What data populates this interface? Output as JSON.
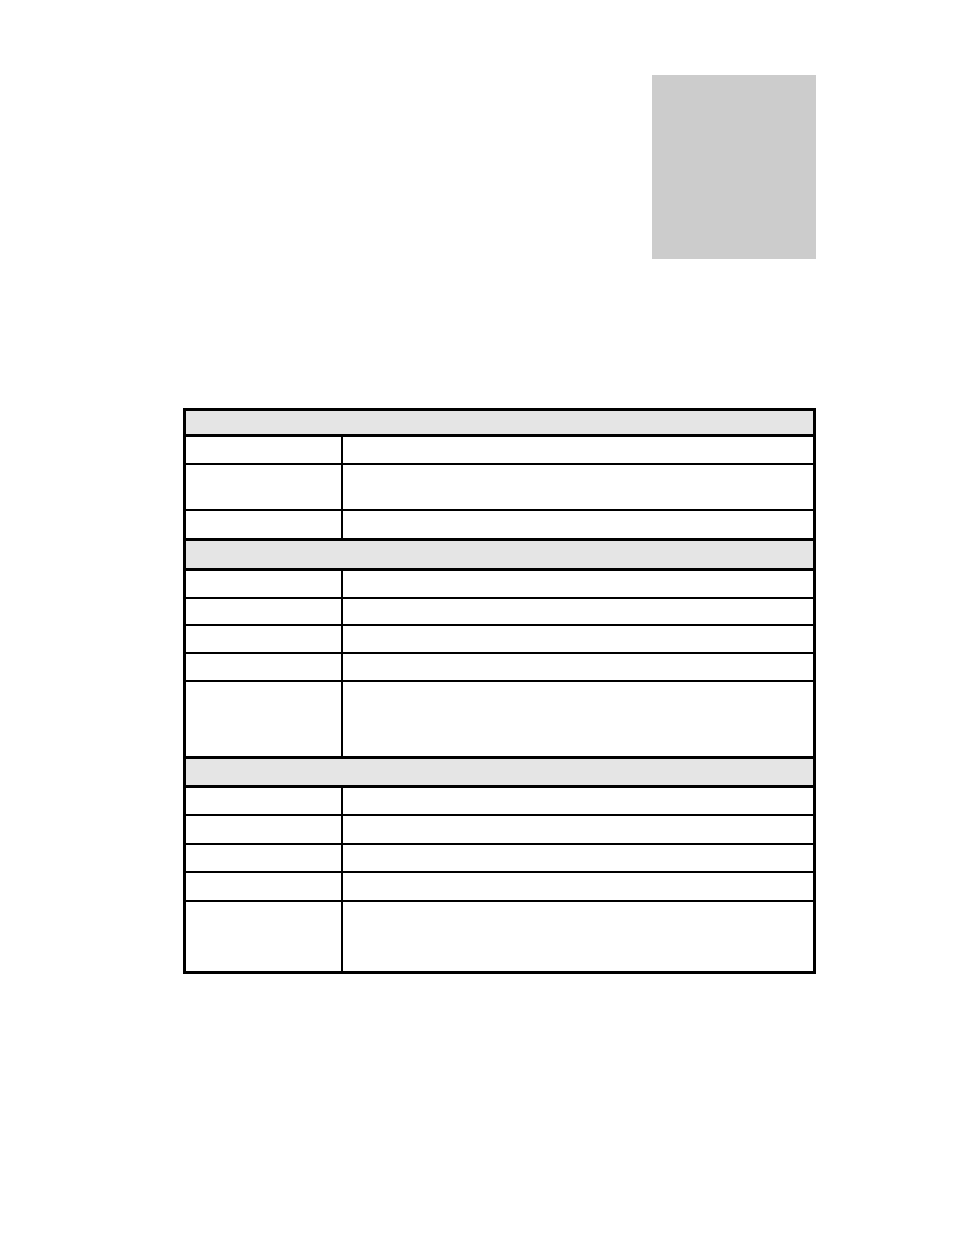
{
  "page": {
    "background": "#ffffff"
  },
  "placeholder_box": {
    "fill": "#cccccc"
  },
  "table": {
    "border_color": "#000000",
    "header_fill": "#e5e5e5",
    "column_count": 2,
    "sections": [
      {
        "header": {
          "label": ""
        },
        "rows": [
          {
            "label": "",
            "value": ""
          },
          {
            "label": "",
            "value": ""
          },
          {
            "label": "",
            "value": ""
          }
        ]
      },
      {
        "header": {
          "label": ""
        },
        "rows": [
          {
            "label": "",
            "value": ""
          },
          {
            "label": "",
            "value": ""
          },
          {
            "label": "",
            "value": ""
          },
          {
            "label": "",
            "value": ""
          },
          {
            "label": "",
            "value": ""
          }
        ]
      },
      {
        "header": {
          "label": ""
        },
        "rows": [
          {
            "label": "",
            "value": ""
          },
          {
            "label": "",
            "value": ""
          },
          {
            "label": "",
            "value": ""
          },
          {
            "label": "",
            "value": ""
          },
          {
            "label": "",
            "value": ""
          }
        ]
      }
    ]
  }
}
